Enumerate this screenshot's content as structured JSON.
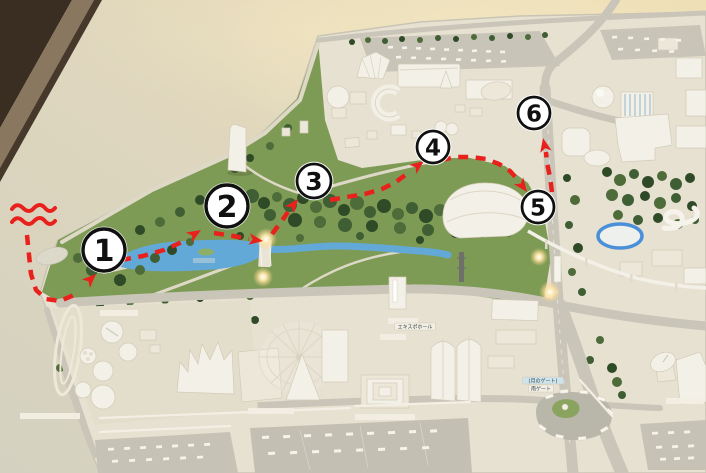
{
  "scene": {
    "kind": "photographed scale model with hand-drawn visitor route",
    "route_color": "#e8211d",
    "badge_fill": "#ffffff",
    "badge_stroke": "#101010"
  },
  "route": {
    "squiggle_paths": [
      "M12,209 q5,-7 11,-1 q6,6 11,0 q6,-6 11,0 q5,6 10,0",
      "M12,222 q5,-7 11,-1 q6,6 11,0 q6,-6 11,0 q5,6 10,0"
    ],
    "segments": [
      {
        "points": [
          [
            27,
            235
          ],
          [
            29,
            255
          ],
          [
            31,
            274
          ],
          [
            36,
            290
          ],
          [
            46,
            299
          ],
          [
            60,
            301
          ],
          [
            74,
            295
          ]
        ],
        "arrow": {
          "x": 96,
          "y": 274,
          "angle": -44
        }
      },
      {
        "points": [
          [
            121,
            260
          ],
          [
            143,
            256
          ],
          [
            164,
            250
          ],
          [
            182,
            242
          ]
        ],
        "arrow": {
          "x": 201,
          "y": 230,
          "angle": -32
        }
      },
      {
        "points": [
          [
            214,
            233
          ],
          [
            233,
            236
          ],
          [
            249,
            239
          ]
        ],
        "arrow": {
          "x": 263,
          "y": 241,
          "angle": 8
        }
      },
      {
        "points": [
          [
            272,
            234
          ],
          [
            281,
            222
          ],
          [
            288,
            212
          ]
        ],
        "arrow": {
          "x": 298,
          "y": 199,
          "angle": -52
        }
      },
      {
        "points": [
          [
            330,
            200
          ],
          [
            347,
            197
          ],
          [
            365,
            194
          ],
          [
            382,
            189
          ],
          [
            396,
            182
          ],
          [
            408,
            173
          ]
        ],
        "arrow": {
          "x": 424,
          "y": 161,
          "angle": -37
        }
      },
      {
        "points": [
          [
            441,
            160
          ],
          [
            456,
            157
          ],
          [
            471,
            157
          ],
          [
            486,
            159
          ],
          [
            499,
            164
          ],
          [
            510,
            171
          ],
          [
            518,
            180
          ]
        ],
        "arrow": {
          "x": 527,
          "y": 192,
          "angle": 53
        }
      },
      {
        "points": [
          [
            552,
            192
          ],
          [
            550,
            177
          ],
          [
            547,
            163
          ],
          [
            546,
            152
          ]
        ],
        "arrow": {
          "x": 543,
          "y": 138,
          "angle": -102
        }
      }
    ]
  },
  "waypoints": [
    {
      "label": "1",
      "x": 104,
      "y": 250,
      "r": 21
    },
    {
      "label": "2",
      "x": 227,
      "y": 206,
      "r": 21
    },
    {
      "label": "3",
      "x": 314,
      "y": 181,
      "r": 17
    },
    {
      "label": "4",
      "x": 433,
      "y": 147,
      "r": 16
    },
    {
      "label": "5",
      "x": 538,
      "y": 207,
      "r": 16
    },
    {
      "label": "6",
      "x": 534,
      "y": 113,
      "r": 16
    }
  ],
  "model_labels": [
    {
      "text": "エキスポホール",
      "x": 415,
      "y": 327,
      "bg": "#f3efe4"
    },
    {
      "text": "(月のゲート)",
      "x": 543,
      "y": 381,
      "bg": "#cfe3ea"
    },
    {
      "text": "南ゲート",
      "x": 541,
      "y": 389,
      "bg": "#f3efe4"
    }
  ]
}
